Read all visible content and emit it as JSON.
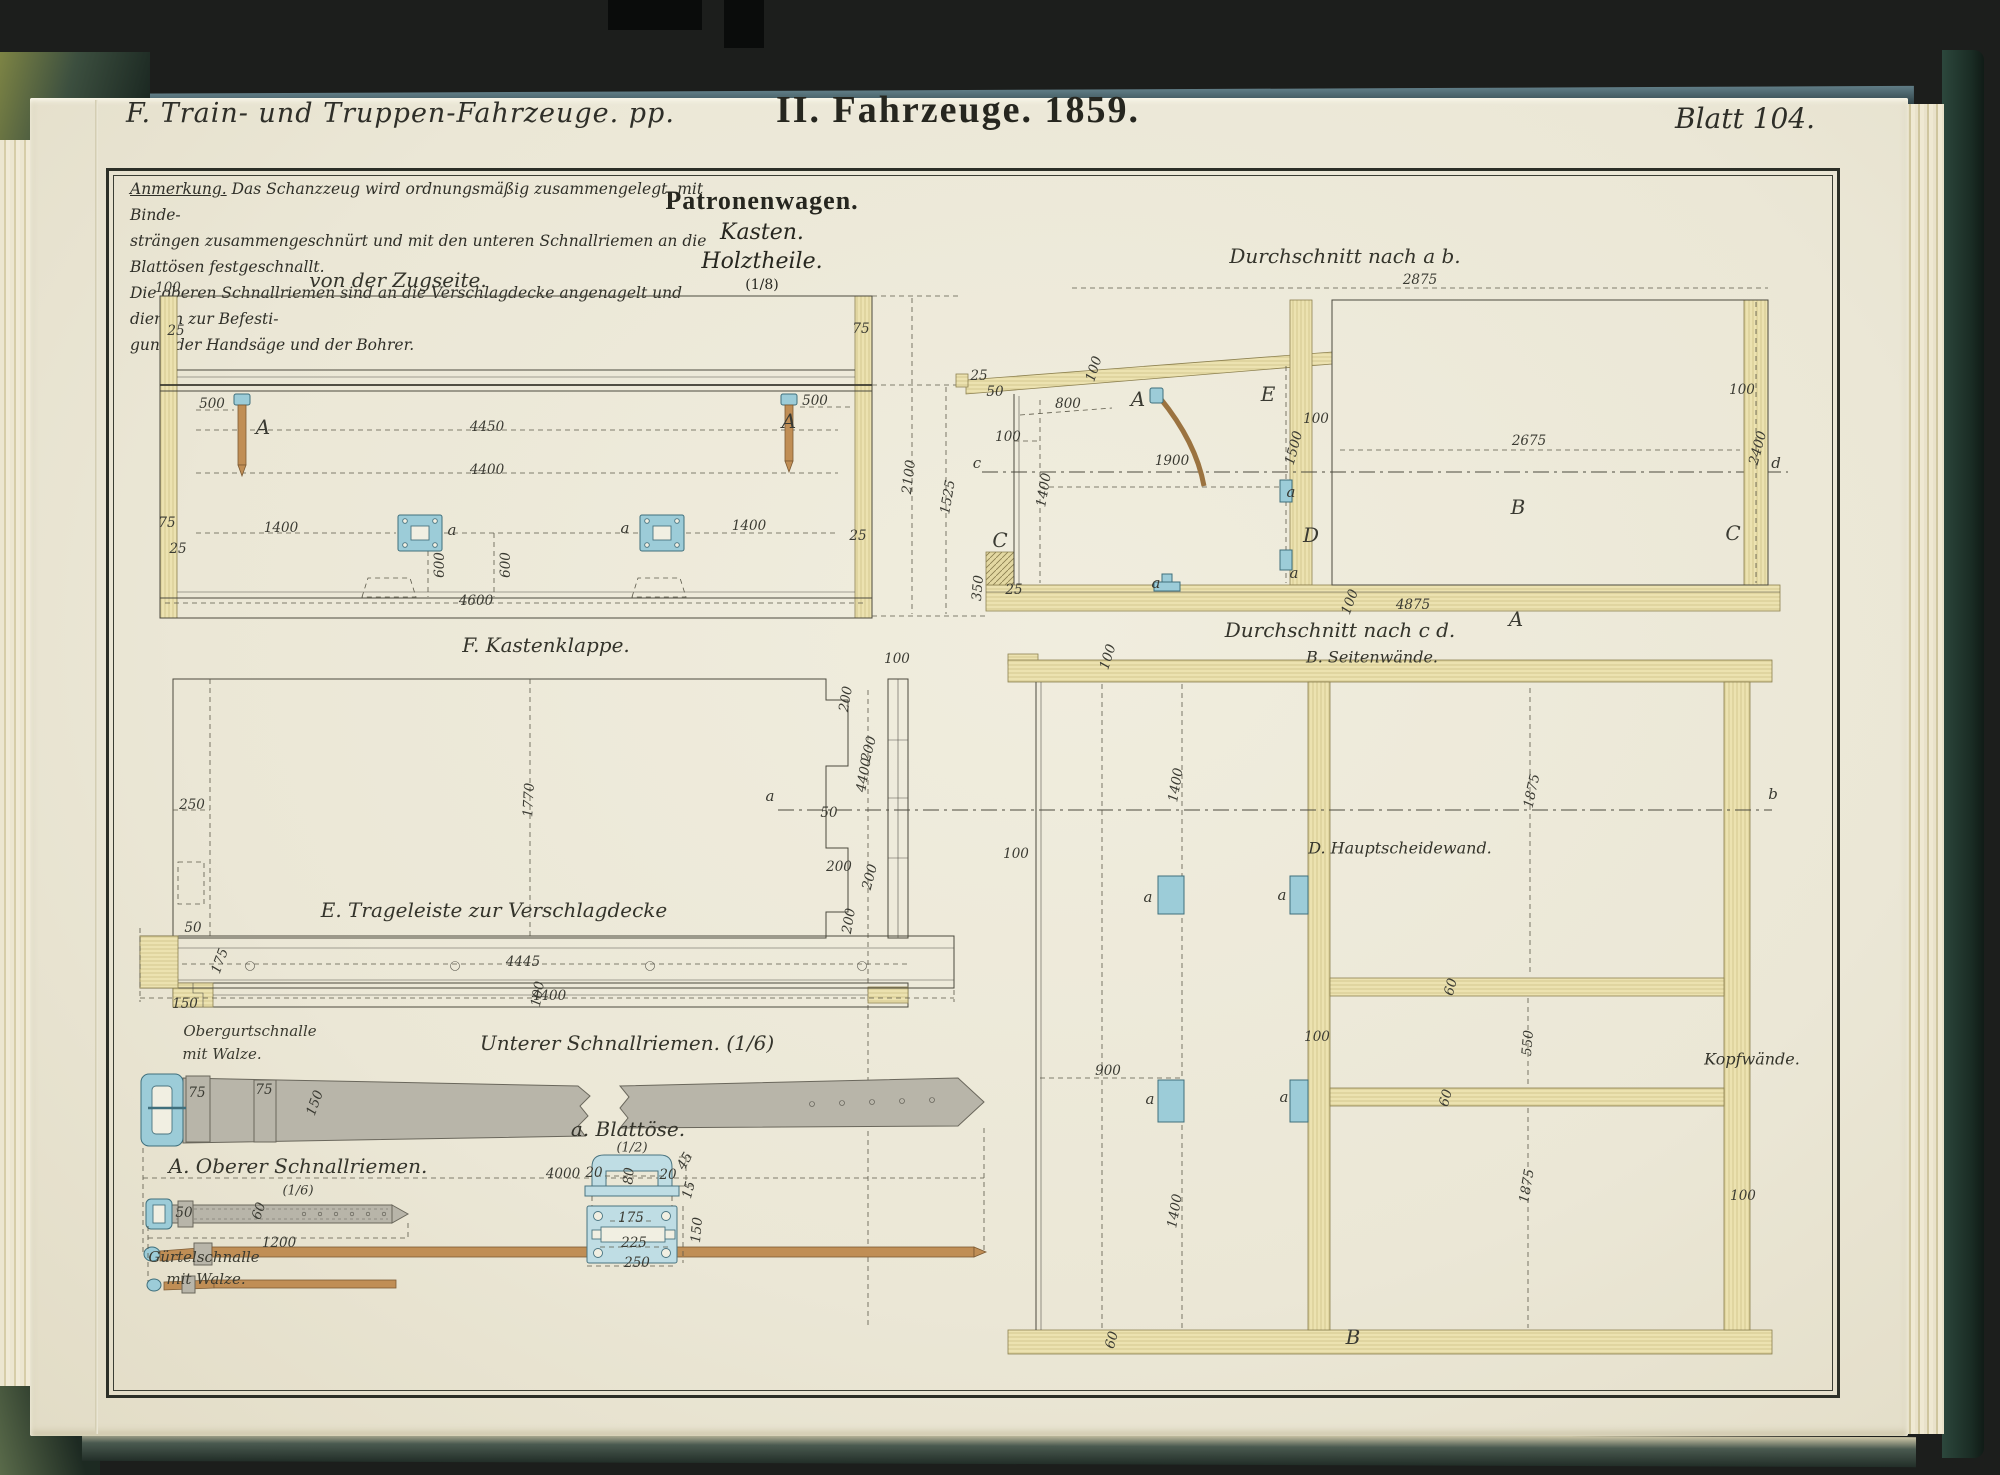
{
  "header": {
    "series": "F. Train- und Truppen-Fahrzeuge. pp.",
    "title": "II. Fahrzeuge. 1859.",
    "sheet": "Blatt 104."
  },
  "note": {
    "label": "Anmerkung.",
    "lines": [
      "Das Schanzzeug wird ordnungsmäßig zusammengelegt, mit Binde-",
      "strängen zusammengeschnürt und mit den unteren Schnallriemen an die Blattösen festgeschnallt.",
      "Die oberen Schnallriemen sind an die Verschlagdecke angenagelt und dienen zur Befesti-",
      "gung der Handsäge und der Bohrer."
    ]
  },
  "titles": {
    "main": "Patronenwagen.",
    "sub1": "Kasten.",
    "sub2": "Holztheile.",
    "scale": "(1/8)"
  },
  "colors": {
    "background": "#1c1e1c",
    "paper": "#ebe7d6",
    "ink": "#3a3a32",
    "frame": "#2c2f27",
    "wood": "#ece2b0",
    "fitting_blue": "#9cccd8",
    "leather_gray": "#b8b5a9",
    "leather_brown": "#c08e55",
    "cover_green": "#2e463c",
    "edge_teal": "#47626a"
  },
  "labels": [
    {
      "t": "von der Zugseite.",
      "x": 398,
      "y": 280,
      "c": "h"
    },
    {
      "t": "Durchschnitt nach a b.",
      "x": 1345,
      "y": 256,
      "c": "h"
    },
    {
      "t": "F. Kastenklappe.",
      "x": 546,
      "y": 645,
      "c": "h"
    },
    {
      "t": "Durchschnitt nach c d.",
      "x": 1340,
      "y": 630,
      "c": "h"
    },
    {
      "t": "B. Seitenwände.",
      "x": 1372,
      "y": 657,
      "c": "h2"
    },
    {
      "t": "E. Trageleiste zur Verschlagdecke",
      "x": 494,
      "y": 910,
      "c": "h"
    },
    {
      "t": "Unterer Schnallriemen. (1/6)",
      "x": 627,
      "y": 1043,
      "c": "h"
    },
    {
      "t": "A. Oberer Schnallriemen.",
      "x": 298,
      "y": 1166,
      "c": "h"
    },
    {
      "t": "(1/6)",
      "x": 298,
      "y": 1191,
      "c": "n2"
    },
    {
      "t": "a. Blattöse.",
      "x": 628,
      "y": 1129,
      "c": "h"
    },
    {
      "t": "(1/2)",
      "x": 632,
      "y": 1148,
      "c": "n2"
    },
    {
      "t": "D. Hauptscheidewand.",
      "x": 1400,
      "y": 848,
      "c": "h2"
    },
    {
      "t": "Kopfwände.",
      "x": 1752,
      "y": 1059,
      "c": "h2"
    },
    {
      "t": "Obergurtschnalle",
      "x": 250,
      "y": 1031,
      "c": "h3"
    },
    {
      "t": "mit Walze.",
      "x": 222,
      "y": 1054,
      "c": "h3"
    },
    {
      "t": "Gürtelschnalle",
      "x": 204,
      "y": 1257,
      "c": "h3"
    },
    {
      "t": "mit Walze.",
      "x": 206,
      "y": 1279,
      "c": "h3"
    },
    {
      "t": "100",
      "x": 168,
      "y": 288
    },
    {
      "t": "25",
      "x": 176,
      "y": 331
    },
    {
      "t": "75",
      "x": 167,
      "y": 523
    },
    {
      "t": "25",
      "x": 178,
      "y": 549
    },
    {
      "t": "500",
      "x": 212,
      "y": 404
    },
    {
      "t": "A",
      "x": 263,
      "y": 427,
      "c": "L"
    },
    {
      "t": "4450",
      "x": 487,
      "y": 427
    },
    {
      "t": "4400",
      "x": 487,
      "y": 470
    },
    {
      "t": "1400",
      "x": 281,
      "y": 528
    },
    {
      "t": "a",
      "x": 452,
      "y": 530,
      "c": "l"
    },
    {
      "t": "a",
      "x": 625,
      "y": 528,
      "c": "l"
    },
    {
      "t": "600",
      "x": 440,
      "y": 565,
      "r": -90
    },
    {
      "t": "600",
      "x": 506,
      "y": 565,
      "r": -90
    },
    {
      "t": "4600",
      "x": 476,
      "y": 601
    },
    {
      "t": "75",
      "x": 861,
      "y": 329
    },
    {
      "t": "500",
      "x": 815,
      "y": 401
    },
    {
      "t": "A",
      "x": 789,
      "y": 421,
      "c": "L"
    },
    {
      "t": "1400",
      "x": 749,
      "y": 526
    },
    {
      "t": "25",
      "x": 858,
      "y": 536
    },
    {
      "t": "2100",
      "x": 909,
      "y": 477,
      "r": -83
    },
    {
      "t": "1525",
      "x": 948,
      "y": 497,
      "r": -80
    },
    {
      "t": "25",
      "x": 979,
      "y": 376
    },
    {
      "t": "50",
      "x": 995,
      "y": 392
    },
    {
      "t": "800",
      "x": 1068,
      "y": 404
    },
    {
      "t": "100",
      "x": 1094,
      "y": 369,
      "r": -72
    },
    {
      "t": "A",
      "x": 1138,
      "y": 399,
      "c": "L"
    },
    {
      "t": "E",
      "x": 1268,
      "y": 394,
      "c": "L"
    },
    {
      "t": "100",
      "x": 1316,
      "y": 419
    },
    {
      "t": "100",
      "x": 1008,
      "y": 437
    },
    {
      "t": "1500",
      "x": 1294,
      "y": 448,
      "r": -75
    },
    {
      "t": "c",
      "x": 977,
      "y": 463,
      "c": "l"
    },
    {
      "t": "1900",
      "x": 1172,
      "y": 461
    },
    {
      "t": "1400",
      "x": 1044,
      "y": 490,
      "r": -80
    },
    {
      "t": "a",
      "x": 1291,
      "y": 492,
      "c": "l"
    },
    {
      "t": "C",
      "x": 1000,
      "y": 540,
      "c": "L"
    },
    {
      "t": "D",
      "x": 1311,
      "y": 535,
      "c": "L"
    },
    {
      "t": "350",
      "x": 978,
      "y": 588,
      "r": -85
    },
    {
      "t": "25",
      "x": 1014,
      "y": 590
    },
    {
      "t": "a",
      "x": 1156,
      "y": 583,
      "c": "l"
    },
    {
      "t": "a",
      "x": 1294,
      "y": 573,
      "c": "l"
    },
    {
      "t": "100",
      "x": 1350,
      "y": 602,
      "r": -70
    },
    {
      "t": "4875",
      "x": 1413,
      "y": 605
    },
    {
      "t": "A",
      "x": 1516,
      "y": 619,
      "c": "L"
    },
    {
      "t": "2875",
      "x": 1420,
      "y": 280
    },
    {
      "t": "100",
      "x": 1742,
      "y": 390
    },
    {
      "t": "2675",
      "x": 1529,
      "y": 441
    },
    {
      "t": "2400",
      "x": 1758,
      "y": 448,
      "r": -75
    },
    {
      "t": "d",
      "x": 1776,
      "y": 463,
      "c": "l"
    },
    {
      "t": "B",
      "x": 1518,
      "y": 507,
      "c": "L"
    },
    {
      "t": "C",
      "x": 1733,
      "y": 533,
      "c": "L"
    },
    {
      "t": "a",
      "x": 770,
      "y": 796,
      "c": "l"
    },
    {
      "t": "b",
      "x": 1773,
      "y": 794,
      "c": "l"
    },
    {
      "t": "4400",
      "x": 864,
      "y": 775,
      "r": -80
    },
    {
      "t": "100",
      "x": 1108,
      "y": 657,
      "r": -72
    },
    {
      "t": "1400",
      "x": 1176,
      "y": 785,
      "r": -80
    },
    {
      "t": "100",
      "x": 1016,
      "y": 854
    },
    {
      "t": "1875",
      "x": 1532,
      "y": 791,
      "r": -78
    },
    {
      "t": "900",
      "x": 1108,
      "y": 1071
    },
    {
      "t": "a",
      "x": 1148,
      "y": 897,
      "c": "l"
    },
    {
      "t": "a",
      "x": 1282,
      "y": 895,
      "c": "l"
    },
    {
      "t": "a",
      "x": 1150,
      "y": 1099,
      "c": "l"
    },
    {
      "t": "a",
      "x": 1284,
      "y": 1097,
      "c": "l"
    },
    {
      "t": "60",
      "x": 1451,
      "y": 987,
      "r": -75
    },
    {
      "t": "550",
      "x": 1528,
      "y": 1043,
      "r": -85
    },
    {
      "t": "60",
      "x": 1446,
      "y": 1098,
      "r": -75
    },
    {
      "t": "100",
      "x": 1317,
      "y": 1037
    },
    {
      "t": "1400",
      "x": 1175,
      "y": 1211,
      "r": -80
    },
    {
      "t": "1875",
      "x": 1527,
      "y": 1186,
      "r": -80
    },
    {
      "t": "100",
      "x": 1743,
      "y": 1196
    },
    {
      "t": "60",
      "x": 1112,
      "y": 1340,
      "r": -75
    },
    {
      "t": "B",
      "x": 1353,
      "y": 1337,
      "c": "L"
    },
    {
      "t": "250",
      "x": 192,
      "y": 805
    },
    {
      "t": "1770",
      "x": 529,
      "y": 800,
      "r": -87
    },
    {
      "t": "4445",
      "x": 523,
      "y": 962
    },
    {
      "t": "100",
      "x": 897,
      "y": 659
    },
    {
      "t": "200",
      "x": 846,
      "y": 699,
      "r": -80
    },
    {
      "t": "200",
      "x": 869,
      "y": 749,
      "r": -75
    },
    {
      "t": "50",
      "x": 829,
      "y": 813
    },
    {
      "t": "200",
      "x": 839,
      "y": 867
    },
    {
      "t": "200",
      "x": 870,
      "y": 877,
      "r": -75
    },
    {
      "t": "200",
      "x": 849,
      "y": 921,
      "r": -80
    },
    {
      "t": "100",
      "x": 538,
      "y": 994,
      "r": -80
    },
    {
      "t": "50",
      "x": 193,
      "y": 928
    },
    {
      "t": "175",
      "x": 220,
      "y": 961,
      "r": -70
    },
    {
      "t": "150",
      "x": 185,
      "y": 1004
    },
    {
      "t": "4400",
      "x": 549,
      "y": 996
    },
    {
      "t": "75",
      "x": 197,
      "y": 1093
    },
    {
      "t": "75",
      "x": 264,
      "y": 1090
    },
    {
      "t": "150",
      "x": 315,
      "y": 1103,
      "r": -70
    },
    {
      "t": "4000",
      "x": 563,
      "y": 1174
    },
    {
      "t": "50",
      "x": 184,
      "y": 1213
    },
    {
      "t": "60",
      "x": 259,
      "y": 1211,
      "r": -70
    },
    {
      "t": "1200",
      "x": 279,
      "y": 1243
    },
    {
      "t": "20",
      "x": 594,
      "y": 1173
    },
    {
      "t": "80",
      "x": 629,
      "y": 1176,
      "r": -85
    },
    {
      "t": "20",
      "x": 668,
      "y": 1175
    },
    {
      "t": "45",
      "x": 685,
      "y": 1161,
      "r": -60
    },
    {
      "t": "15",
      "x": 689,
      "y": 1190,
      "r": -75
    },
    {
      "t": "175",
      "x": 631,
      "y": 1218
    },
    {
      "t": "225",
      "x": 634,
      "y": 1243
    },
    {
      "t": "150",
      "x": 697,
      "y": 1230,
      "r": -85
    },
    {
      "t": "250",
      "x": 637,
      "y": 1263
    }
  ]
}
